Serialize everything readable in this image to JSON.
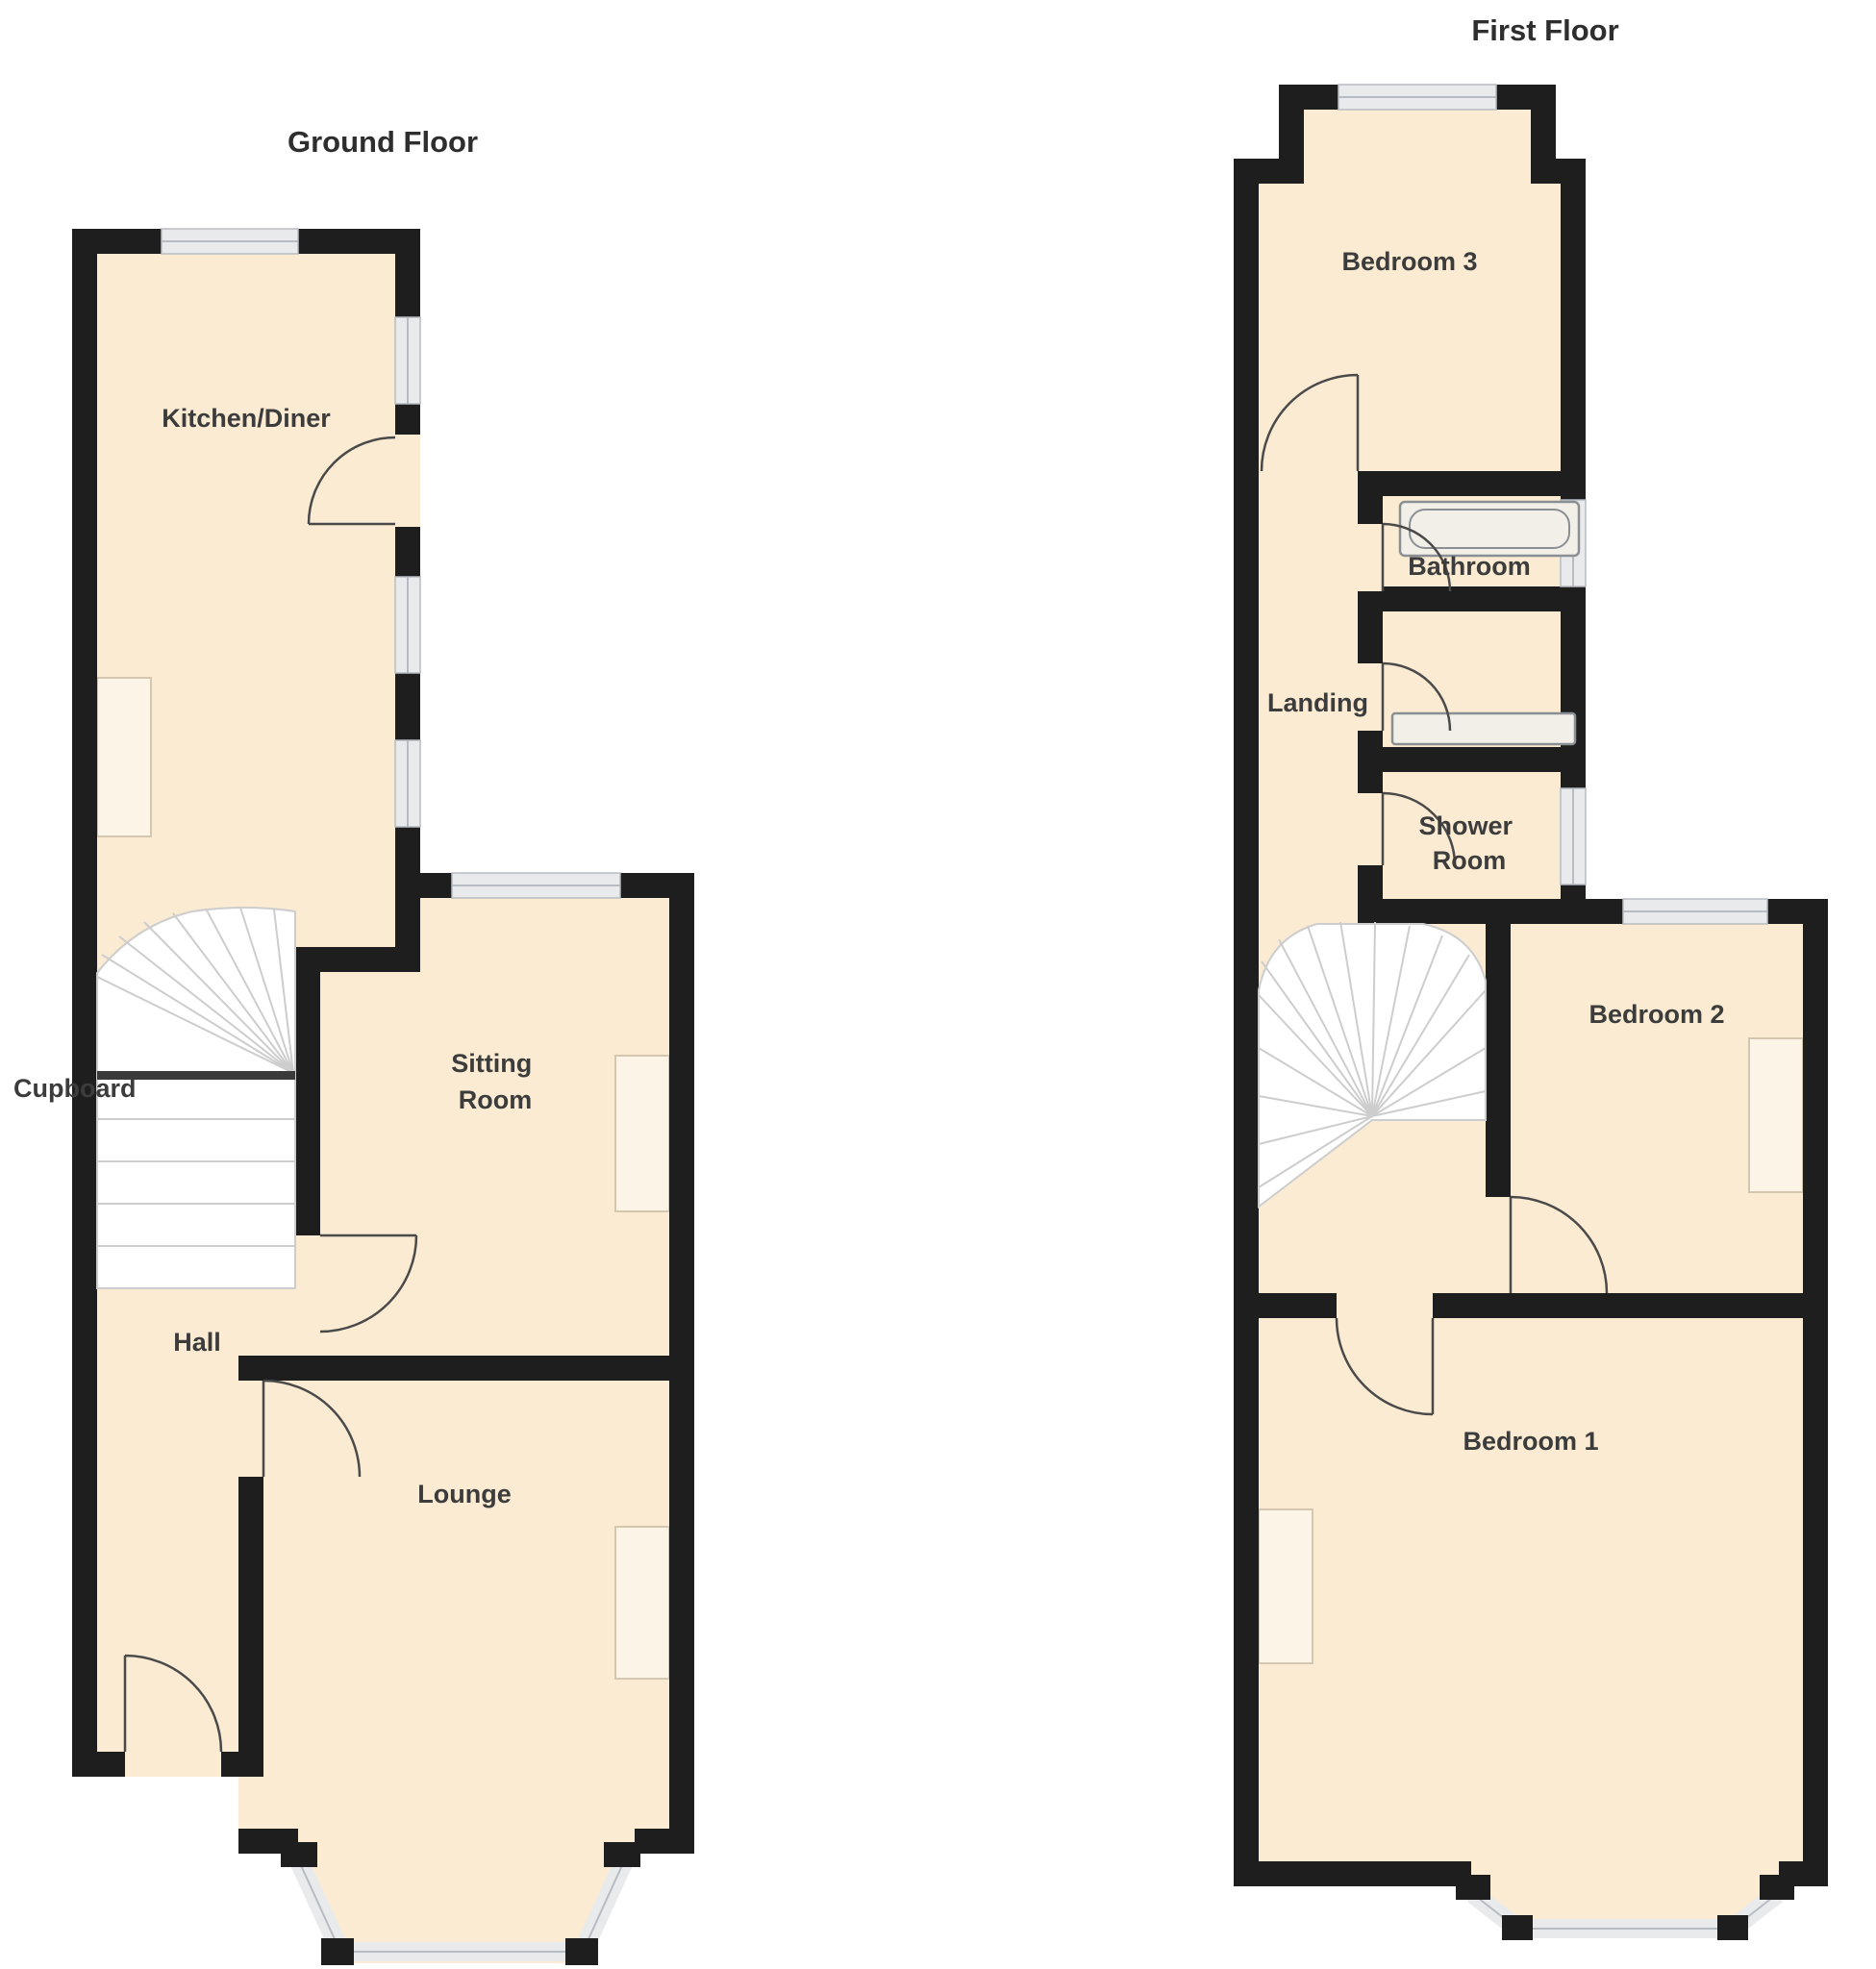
{
  "colors": {
    "background": "#ffffff",
    "floor": "#FAEBD2",
    "wall": "#1E1E1E",
    "window": "#E8EAEC",
    "window-edge": "#B7BCC2",
    "stair": "#FFFFFF",
    "stair-line": "#CDCDCD",
    "door": "#4A4A4A",
    "recess": "#FCF5E7",
    "recess-edge": "#D3C8AF",
    "text": "#3C3C3C"
  },
  "plans": [
    {
      "title": "Ground Floor",
      "rooms": [
        {
          "label": "Kitchen/Diner"
        },
        {
          "label": "Cupboard"
        },
        {
          "label": "Sitting Room",
          "line1": "Sitting",
          "line2": "Room"
        },
        {
          "label": "Hall"
        },
        {
          "label": "Lounge"
        }
      ]
    },
    {
      "title": "First Floor",
      "rooms": [
        {
          "label": "Bedroom 3"
        },
        {
          "label": "Bathroom"
        },
        {
          "label": "Landing"
        },
        {
          "label": "Shower Room",
          "line1": "Shower",
          "line2": "Room"
        },
        {
          "label": "Bedroom 2"
        },
        {
          "label": "Bedroom 1"
        }
      ]
    }
  ]
}
